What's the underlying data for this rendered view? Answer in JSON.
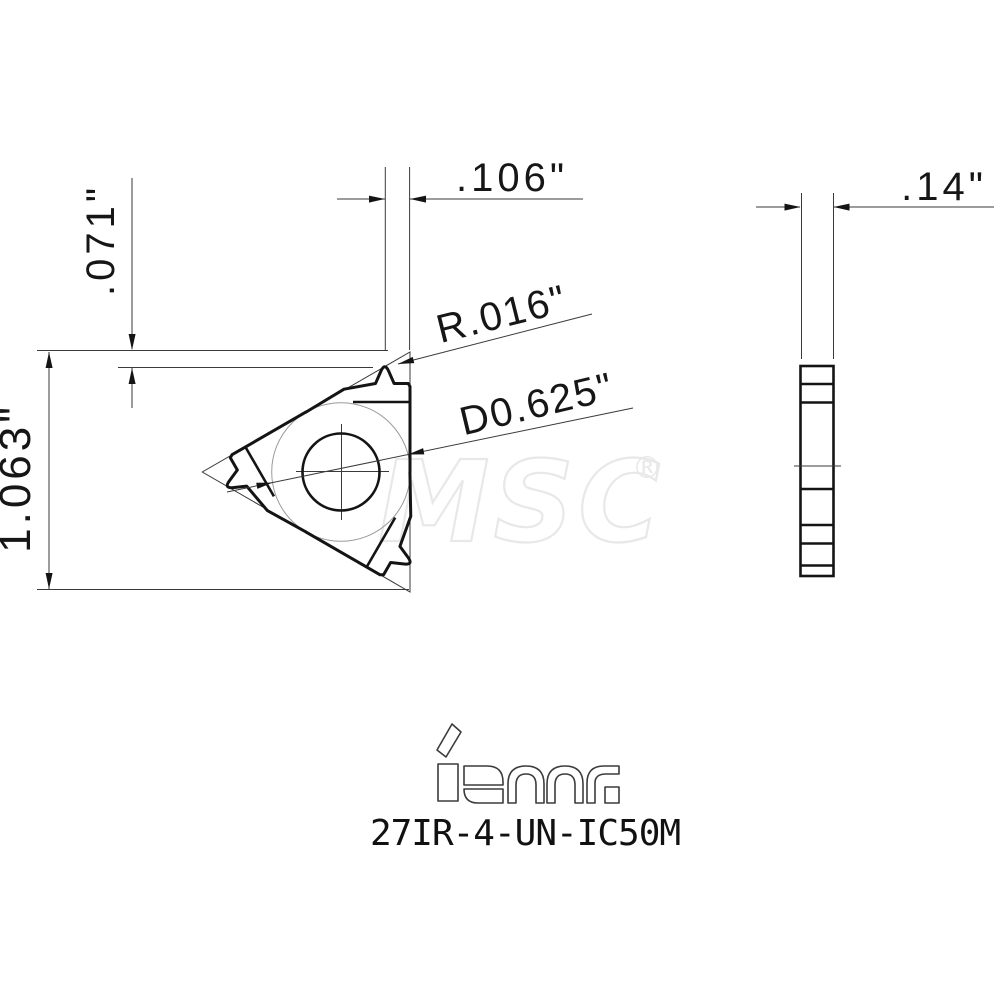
{
  "front_view": {
    "offset_dim": ".071\"",
    "tip_width_dim": ".106\"",
    "height_dim": "1.063\"",
    "radius_dim": "R.016\"",
    "diameter_dim": "D0.625\""
  },
  "side_view": {
    "thickness_dim": ".14\""
  },
  "branding": {
    "logo_text": "iscar",
    "part_number": "27IR-4-UN-IC50M"
  },
  "watermark": {
    "text": "MSC",
    "registered": "®"
  },
  "colors": {
    "line": "#141414",
    "thin_line": "#3a3a3a",
    "construction": "#9a9a9a",
    "watermark": "#e8e8e8",
    "background": "#ffffff"
  }
}
